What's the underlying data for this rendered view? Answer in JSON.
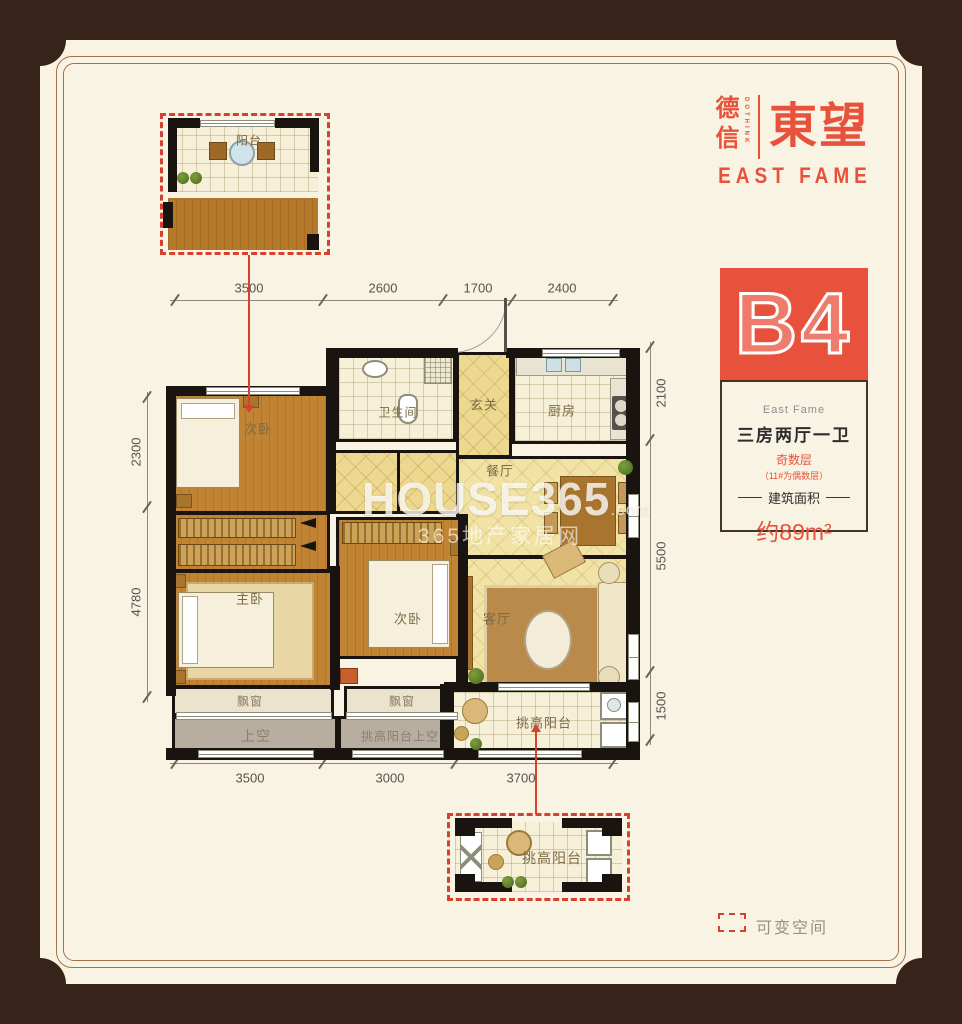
{
  "brand": {
    "cn": "德信",
    "cn_sub": "DOTHINK",
    "main": "東望",
    "en": "EAST FAME"
  },
  "unit": {
    "code": "B4",
    "project": "East Fame",
    "layout": "三房两厅一卫",
    "floor_note": "奇数层",
    "floor_note_detail": "（11#为偶数层）",
    "area_label": "建筑面积",
    "area_value": "约89m²"
  },
  "rooms": {
    "balcony_inset": "阳台",
    "bed_top": "次卧",
    "bath": "卫生间",
    "entry": "玄关",
    "kitchen": "厨房",
    "dining": "餐厅",
    "master": "主卧",
    "bed_mid": "次卧",
    "living": "客厅",
    "bay_left": "飘窗",
    "bay_mid": "飘窗",
    "tall_balcony": "挑高阳台",
    "void_left": "上空",
    "void_mid": "挑高阳台上空",
    "tall_balcony_inset": "挑高阳台"
  },
  "dims": {
    "top": [
      "3500",
      "2600",
      "1700",
      "2400"
    ],
    "left": [
      "2300",
      "4780"
    ],
    "right": [
      "2100",
      "5500",
      "1500"
    ],
    "bottom": [
      "3500",
      "3000",
      "3700"
    ]
  },
  "legend": {
    "variable_space": "可变空间"
  },
  "watermark": {
    "brand": "HOUSE365",
    "domain": ".com",
    "tagline": "365地产家居网"
  },
  "colors": {
    "accent": "#e8513b",
    "frame": "#38231a",
    "wall": "#1a1410",
    "paper": "#f8f3e2"
  }
}
